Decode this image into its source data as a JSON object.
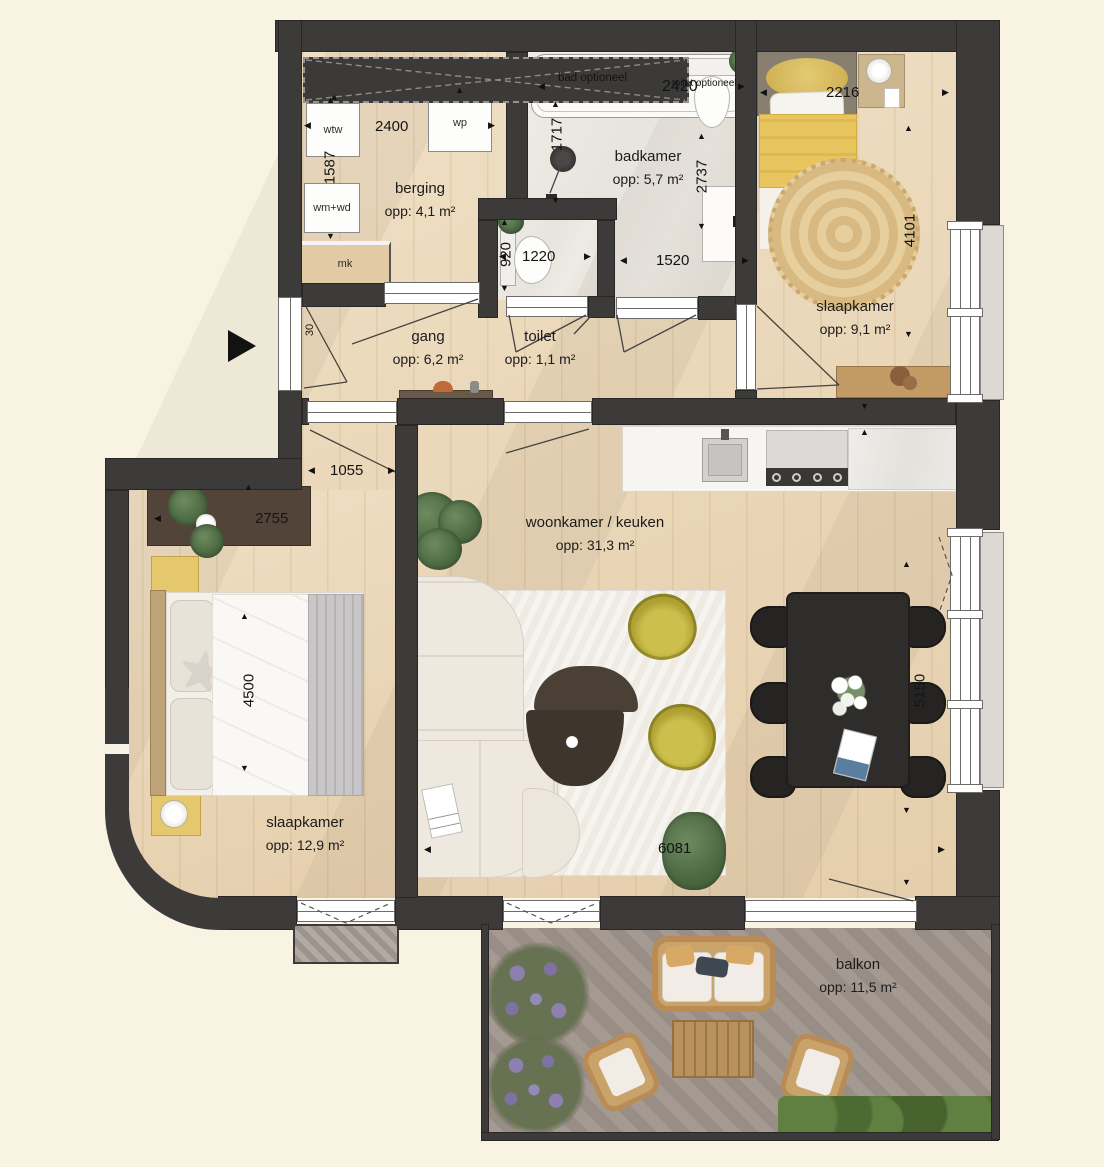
{
  "rooms": [
    {
      "name": "berging",
      "area": "opp:  4,1 m²"
    },
    {
      "name": "badkamer",
      "area": "opp:  5,7 m²"
    },
    {
      "name": "slaapkamer",
      "area": "opp:  9,1 m²"
    },
    {
      "name": "gang",
      "area": "opp:  6,2 m²"
    },
    {
      "name": "toilet",
      "area": "opp:  1,1 m²"
    },
    {
      "name": "woonkamer / keuken",
      "area": "opp:  31,3 m²"
    },
    {
      "name": "slaapkamer",
      "area": "opp:  12,9 m²"
    },
    {
      "name": "balkon",
      "area": "opp:  11,5 m²"
    }
  ],
  "fixtures": {
    "wtw": "wtw",
    "wp": "wp",
    "wm_wd": "wm+wd",
    "mk": "mk",
    "bad_optioneel": "bad optioneel",
    "toilet_optioneel": "toilet optioneel"
  },
  "dims": {
    "d2400": "2400",
    "d1587": "1587",
    "d2420": "2420",
    "d1717": "1717",
    "d2216": "2216",
    "d2737": "2737",
    "d4101": "4101",
    "d920": "920",
    "d1220": "1220",
    "d1520": "1520",
    "d1055": "1055",
    "d2755": "2755",
    "d30": "30",
    "d4500": "4500",
    "d5150": "5150",
    "d6081": "6081"
  },
  "colors": {
    "wall": "#3d3b3a",
    "wood_floor": "#ebd6b4",
    "bath_floor": "#ebe8e2",
    "balcony_floor": "#a0958d",
    "accent_olive": "#bfb13d",
    "bedding_yellow": "#e8c45f",
    "background": "#f8f3e2"
  }
}
